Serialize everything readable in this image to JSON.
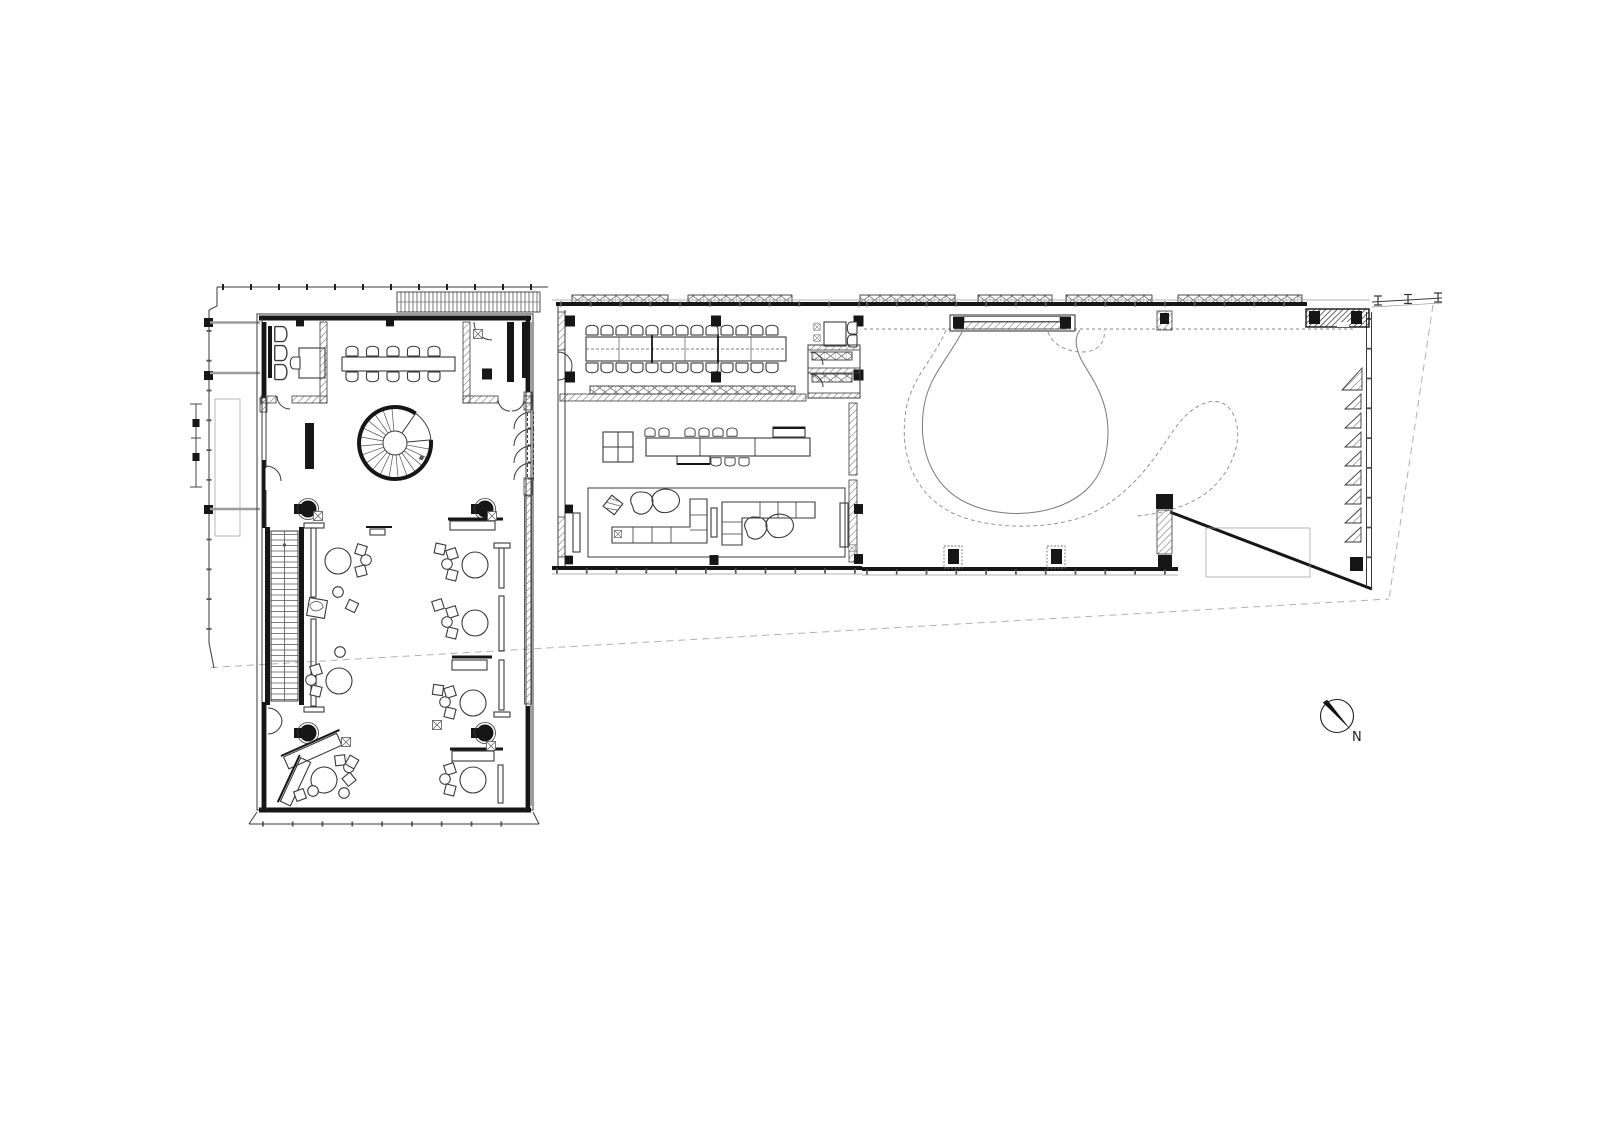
{
  "document": {
    "type": "architectural floor plan, black line work on white paper",
    "visible_text": [
      "N"
    ]
  },
  "compass": {
    "label": "N"
  },
  "palette": {
    "paper": "#ffffff",
    "ink": "#1f1f1f",
    "wall": "#161616",
    "line": "#3a3a3a",
    "faint": "#9a9a9a",
    "site": "#b0b0b0",
    "hatch": "#6e6e6e",
    "beam": "#9c9c9c"
  },
  "inventory": {
    "left_wing": {
      "lobby_armchairs": 3,
      "office_desk": 1,
      "conference_table_chairs": 10,
      "spiral_staircase": 1,
      "straight_staircase": 1,
      "round_columns": 4,
      "reading_tables": 7,
      "shelving_units": 6,
      "folding_doors": 4
    },
    "canteen_wing": {
      "long_table_chairs": 26,
      "side_table_chairs": 2,
      "bar_counter_segments": 3,
      "bar_stools": 9,
      "square_table": 1,
      "sectional_sofas": 2,
      "organic_coffee_tables": 4,
      "side_tables": 2
    },
    "event_hall": {
      "organic_floor_inlay": 1,
      "wardrobe_bench": 1,
      "louver_triangles": 9,
      "columns": 8
    },
    "site": {
      "property_line": "dashed, running diagonally below the building",
      "scale_bar": 1,
      "north_arrow": 1
    }
  }
}
